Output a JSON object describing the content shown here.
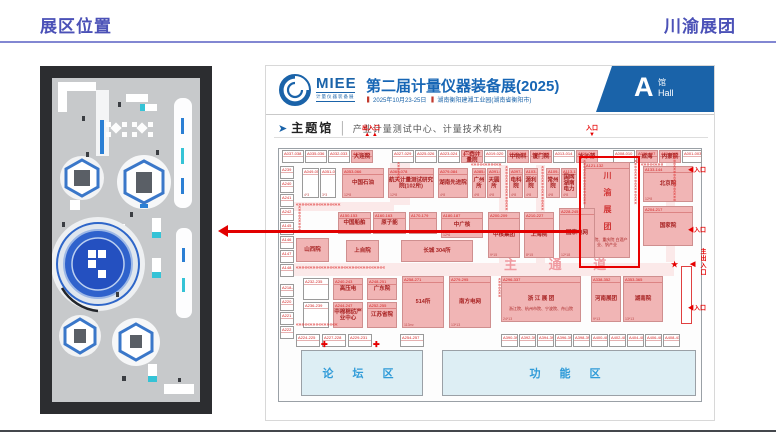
{
  "header": {
    "left": "展区位置",
    "right": "川渝展团"
  },
  "expo": {
    "brand": "MIEE",
    "brand_sub": "计量仪器装备展",
    "title": "第二届计量仪器装备展(2025)",
    "date": "2025年10月23-25日",
    "venue": "湖南衡阳建湘工业园(湖南省衡阳市)",
    "hall": {
      "letter": "A",
      "cn": "馆",
      "en": "Hall"
    },
    "section": {
      "marker": "➤",
      "name": "主题馆",
      "divider": "│",
      "desc": "产业计量测试中心、计量技术机构"
    }
  },
  "map": {
    "labels": {
      "forum": "论 坛 区",
      "function": "功 能 区"
    },
    "booths": [
      {
        "x": 16,
        "y": 84,
        "w": 22,
        "h": 13,
        "t": "w",
        "n": "A037-038"
      },
      {
        "x": 39,
        "y": 84,
        "w": 22,
        "h": 13,
        "t": "w",
        "n": "A035-036"
      },
      {
        "x": 62,
        "y": 84,
        "w": 22,
        "h": 13,
        "t": "w",
        "n": "A032-033"
      },
      {
        "x": 85,
        "y": 84,
        "w": 22,
        "h": 13,
        "t": "p",
        "n": "A030-031",
        "m": "大连院"
      },
      {
        "x": 126,
        "y": 84,
        "w": 22,
        "h": 13,
        "t": "w",
        "n": "A027-029"
      },
      {
        "x": 149,
        "y": 84,
        "w": 22,
        "h": 13,
        "t": "w",
        "n": "A025-026"
      },
      {
        "x": 172,
        "y": 84,
        "w": 22,
        "h": 13,
        "t": "w",
        "n": "A023-024"
      },
      {
        "x": 195,
        "y": 84,
        "w": 22,
        "h": 13,
        "t": "p",
        "n": "A021-022",
        "m": "广西计量院"
      },
      {
        "x": 218,
        "y": 84,
        "w": 22,
        "h": 13,
        "t": "w",
        "n": "A019-020"
      },
      {
        "x": 241,
        "y": 84,
        "w": 22,
        "h": 13,
        "t": "p",
        "n": "A017-018",
        "m": "中物科"
      },
      {
        "x": 264,
        "y": 84,
        "w": 22,
        "h": 13,
        "t": "p",
        "n": "A015-016",
        "m": "厦门院"
      },
      {
        "x": 287,
        "y": 84,
        "w": 22,
        "h": 13,
        "t": "w",
        "n": "A013-014"
      },
      {
        "x": 310,
        "y": 84,
        "w": 22,
        "h": 13,
        "t": "p",
        "n": "A011-012",
        "m": "水沙源"
      },
      {
        "x": 347,
        "y": 84,
        "w": 22,
        "h": 13,
        "t": "w",
        "n": "A008-010"
      },
      {
        "x": 370,
        "y": 84,
        "w": 22,
        "h": 13,
        "t": "p",
        "n": "A006-007",
        "m": "成海"
      },
      {
        "x": 393,
        "y": 84,
        "w": 22,
        "h": 13,
        "t": "p",
        "n": "A004-005",
        "m": "内蒙院"
      },
      {
        "x": 416,
        "y": 84,
        "w": 20,
        "h": 13,
        "t": "w",
        "n": "A001-003"
      },
      {
        "x": 14,
        "y": 100,
        "w": 14,
        "h": 13,
        "t": "w",
        "n": "A239"
      },
      {
        "x": 14,
        "y": 114,
        "w": 14,
        "h": 13,
        "t": "w",
        "n": "A240"
      },
      {
        "x": 14,
        "y": 128,
        "w": 14,
        "h": 13,
        "t": "w",
        "n": "A241"
      },
      {
        "x": 14,
        "y": 142,
        "w": 14,
        "h": 13,
        "t": "w",
        "n": "A242"
      },
      {
        "x": 14,
        "y": 156,
        "w": 14,
        "h": 13,
        "t": "w",
        "n": "A145"
      },
      {
        "x": 14,
        "y": 170,
        "w": 14,
        "h": 13,
        "t": "w",
        "n": "A146"
      },
      {
        "x": 14,
        "y": 184,
        "w": 14,
        "h": 13,
        "t": "w",
        "n": "A147"
      },
      {
        "x": 14,
        "y": 198,
        "w": 14,
        "h": 13,
        "t": "w",
        "n": "A148"
      },
      {
        "x": 14,
        "y": 218,
        "w": 14,
        "h": 13,
        "t": "w",
        "n": "A218-219"
      },
      {
        "x": 14,
        "y": 232,
        "w": 14,
        "h": 13,
        "t": "w",
        "n": "A220"
      },
      {
        "x": 14,
        "y": 246,
        "w": 14,
        "h": 13,
        "t": "w",
        "n": "A221"
      },
      {
        "x": 14,
        "y": 260,
        "w": 14,
        "h": 13,
        "t": "w",
        "n": "A222"
      },
      {
        "x": 36,
        "y": 102,
        "w": 17,
        "h": 30,
        "t": "w",
        "n": "A049-050",
        "s": "4*3"
      },
      {
        "x": 54,
        "y": 102,
        "w": 16,
        "h": 30,
        "t": "w",
        "n": "A051-052",
        "s": "3*3"
      },
      {
        "x": 76,
        "y": 102,
        "w": 42,
        "h": 30,
        "t": "p",
        "n": "A053-066",
        "m": "中国石油",
        "s": "12*8"
      },
      {
        "x": 122,
        "y": 102,
        "w": 46,
        "h": 30,
        "t": "p",
        "n": "A067-078",
        "m": "航天计量测试研究院(102所)",
        "s": "12*8"
      },
      {
        "x": 172,
        "y": 102,
        "w": 30,
        "h": 30,
        "t": "p",
        "n": "A079-084",
        "m": "湖南先进院",
        "s": "4*8"
      },
      {
        "x": 206,
        "y": 102,
        "w": 14,
        "h": 30,
        "t": "p",
        "n": "A085-090",
        "m": "广州所",
        "s": "4*8"
      },
      {
        "x": 221,
        "y": 102,
        "w": 14,
        "h": 30,
        "t": "p",
        "n": "A091-096",
        "m": "天圆所",
        "s": "4*8"
      },
      {
        "x": 243,
        "y": 102,
        "w": 14,
        "h": 30,
        "t": "p",
        "n": "A097-102",
        "m": "电科院",
        "s": "4*8"
      },
      {
        "x": 258,
        "y": 102,
        "w": 14,
        "h": 30,
        "t": "p",
        "n": "A103-108",
        "m": "源利院",
        "s": "4*8"
      },
      {
        "x": 280,
        "y": 102,
        "w": 14,
        "h": 30,
        "t": "p",
        "n": "A109-112",
        "m": "常州院",
        "s": "4*8"
      },
      {
        "x": 295,
        "y": 102,
        "w": 16,
        "h": 30,
        "t": "p",
        "n": "A113-120",
        "m": "国网湖南电力",
        "s": "4*8"
      },
      {
        "x": 318,
        "y": 96,
        "w": 46,
        "h": 96,
        "t": "hl",
        "n": "A121-132",
        "m": "川渝展团",
        "v": true,
        "sub": "中物院、重庆院\n白酒产业、钒产业",
        "s": "12*28"
      },
      {
        "x": 377,
        "y": 100,
        "w": 50,
        "h": 36,
        "t": "p",
        "n": "A133-144",
        "m": "北京院",
        "s": "12*8"
      },
      {
        "x": 377,
        "y": 140,
        "w": 50,
        "h": 40,
        "t": "p",
        "n": "A204-217",
        "m": "国家院"
      },
      {
        "x": 72,
        "y": 146,
        "w": 33,
        "h": 22,
        "t": "p",
        "n": "A150-153",
        "m": "中国船舶"
      },
      {
        "x": 107,
        "y": 146,
        "w": 33,
        "h": 22,
        "t": "p",
        "n": "A160-163",
        "m": "原子能"
      },
      {
        "x": 143,
        "y": 146,
        "w": 28,
        "h": 22,
        "t": "p",
        "n": "A170-179"
      },
      {
        "x": 175,
        "y": 146,
        "w": 42,
        "h": 26,
        "t": "p",
        "n": "A180-187",
        "m": "中广核",
        "s": "12*6"
      },
      {
        "x": 222,
        "y": 146,
        "w": 32,
        "h": 46,
        "t": "p",
        "n": "A200-209",
        "m": "中核集团",
        "s": "9*15"
      },
      {
        "x": 258,
        "y": 146,
        "w": 30,
        "h": 46,
        "t": "p",
        "n": "A210-227",
        "m": "上海院",
        "s": "8*15"
      },
      {
        "x": 293,
        "y": 142,
        "w": 36,
        "h": 50,
        "t": "p",
        "n": "A228-245",
        "m": "国家电网",
        "s": "12*18"
      },
      {
        "x": 30,
        "y": 172,
        "w": 33,
        "h": 24,
        "t": "p",
        "m": "山西院"
      },
      {
        "x": 80,
        "y": 174,
        "w": 33,
        "h": 22,
        "t": "p",
        "m": "上自院"
      },
      {
        "x": 135,
        "y": 174,
        "w": 72,
        "h": 22,
        "t": "p",
        "m": "长城 304所"
      },
      {
        "x": 37,
        "y": 212,
        "w": 26,
        "h": 22,
        "t": "w",
        "n": "A232-235"
      },
      {
        "x": 67,
        "y": 212,
        "w": 30,
        "h": 22,
        "t": "p",
        "n": "A240-243",
        "m": "高压电"
      },
      {
        "x": 101,
        "y": 212,
        "w": 30,
        "h": 22,
        "t": "p",
        "n": "A248-251",
        "m": "广东院"
      },
      {
        "x": 37,
        "y": 236,
        "w": 26,
        "h": 26,
        "t": "w",
        "n": "A236-239"
      },
      {
        "x": 67,
        "y": 236,
        "w": 30,
        "h": 26,
        "t": "p",
        "n": "A244-247",
        "m": "中棉棉纺产业中心"
      },
      {
        "x": 101,
        "y": 236,
        "w": 30,
        "h": 26,
        "t": "p",
        "n": "A252-255",
        "m": "江苏省院"
      },
      {
        "x": 136,
        "y": 210,
        "w": 42,
        "h": 52,
        "t": "p",
        "n": "A258-271",
        "m": "514所",
        "s": "113m²"
      },
      {
        "x": 183,
        "y": 210,
        "w": 42,
        "h": 52,
        "t": "p",
        "n": "A279-295",
        "m": "南方电网",
        "s": "13*13"
      },
      {
        "x": 235,
        "y": 210,
        "w": 80,
        "h": 46,
        "t": "p",
        "n": "A296-337",
        "m": "浙 江 展 团",
        "sub": "浙江院、杭州市院、宁波院、舟山院",
        "s": "24*13"
      },
      {
        "x": 325,
        "y": 210,
        "w": 30,
        "h": 46,
        "t": "p",
        "n": "A338-352",
        "m": "河南展团",
        "s": "9*13"
      },
      {
        "x": 357,
        "y": 210,
        "w": 40,
        "h": 46,
        "t": "p",
        "n": "A353-365",
        "m": "湖南院",
        "s": "13*13"
      },
      {
        "x": 30,
        "y": 268,
        "w": 24,
        "h": 13,
        "t": "w",
        "n": "A224-225"
      },
      {
        "x": 56,
        "y": 268,
        "w": 24,
        "h": 13,
        "t": "w",
        "n": "A227-228"
      },
      {
        "x": 82,
        "y": 268,
        "w": 24,
        "h": 13,
        "t": "w",
        "n": "A229-231"
      },
      {
        "x": 134,
        "y": 268,
        "w": 24,
        "h": 13,
        "t": "w",
        "n": "A254-257"
      },
      {
        "x": 235,
        "y": 268,
        "w": 17,
        "h": 13,
        "t": "w",
        "n": "A390-391"
      },
      {
        "x": 253,
        "y": 268,
        "w": 17,
        "h": 13,
        "t": "w",
        "n": "A392-393"
      },
      {
        "x": 271,
        "y": 268,
        "w": 17,
        "h": 13,
        "t": "w",
        "n": "A394-395"
      },
      {
        "x": 289,
        "y": 268,
        "w": 17,
        "h": 13,
        "t": "w",
        "n": "A396-397"
      },
      {
        "x": 307,
        "y": 268,
        "w": 17,
        "h": 13,
        "t": "w",
        "n": "A398-399"
      },
      {
        "x": 325,
        "y": 268,
        "w": 17,
        "h": 13,
        "t": "w",
        "n": "A400-401"
      },
      {
        "x": 343,
        "y": 268,
        "w": 17,
        "h": 13,
        "t": "w",
        "n": "A402-403"
      },
      {
        "x": 361,
        "y": 268,
        "w": 17,
        "h": 13,
        "t": "w",
        "n": "A404-405"
      },
      {
        "x": 379,
        "y": 268,
        "w": 17,
        "h": 13,
        "t": "w",
        "n": "A406-407"
      },
      {
        "x": 397,
        "y": 268,
        "w": 17,
        "h": 13,
        "t": "w",
        "n": "A408-410"
      }
    ],
    "marks": [
      {
        "x": 96,
        "y": 60,
        "l": "出入口\n▲ ▲",
        "fs": 6
      },
      {
        "x": 320,
        "y": 60,
        "l": "入口\n▼",
        "fs": 6
      },
      {
        "x": 422,
        "y": 102,
        "l": "◀入口",
        "fs": 6
      },
      {
        "x": 422,
        "y": 162,
        "l": "◀入口",
        "fs": 6
      },
      {
        "x": 433,
        "y": 182,
        "l": "主出入口",
        "vert": true,
        "fs": 6
      },
      {
        "x": 424,
        "y": 196,
        "l": "◀",
        "fs": 7
      },
      {
        "x": 422,
        "y": 240,
        "l": "◀入口",
        "fs": 6
      },
      {
        "x": 405,
        "y": 196,
        "l": "★",
        "fs": 8
      },
      {
        "x": 55,
        "y": 276,
        "l": "✚",
        "fs": 8
      },
      {
        "x": 107,
        "y": 276,
        "l": "✚",
        "fs": 8
      },
      {
        "x": 238,
        "y": 196,
        "l": "主 通 道",
        "big": true
      }
    ],
    "aisles": [
      {
        "x": 30,
        "y": 137,
        "len": 100,
        "o": "h"
      },
      {
        "x": 205,
        "y": 97,
        "len": 68,
        "o": "h"
      },
      {
        "x": 375,
        "y": 97,
        "len": 52,
        "o": "h"
      },
      {
        "x": 30,
        "y": 200,
        "len": 195,
        "o": "h"
      },
      {
        "x": 30,
        "y": 257,
        "len": 90,
        "o": "h"
      },
      {
        "x": 128,
        "y": 96,
        "len": 44,
        "o": "v"
      },
      {
        "x": 236,
        "y": 100,
        "len": 96,
        "o": "v"
      },
      {
        "x": 272,
        "y": 100,
        "len": 96,
        "o": "v"
      },
      {
        "x": 314,
        "y": 94,
        "len": 98,
        "o": "v"
      },
      {
        "x": 365,
        "y": 94,
        "len": 98,
        "o": "v"
      },
      {
        "x": 404,
        "y": 88,
        "len": 106,
        "o": "v"
      },
      {
        "x": 29,
        "y": 140,
        "len": 58,
        "o": "v"
      },
      {
        "x": 229,
        "y": 212,
        "len": 46,
        "o": "v"
      }
    ]
  },
  "colors": {
    "accent_blue": "#1a63a9",
    "booth_pink": "#f1b5b5",
    "booth_red_text": "#c22222",
    "highlight_red": "#e60000",
    "zone_blue_text": "#2f9bd8",
    "header_purple": "#4b51b7"
  }
}
